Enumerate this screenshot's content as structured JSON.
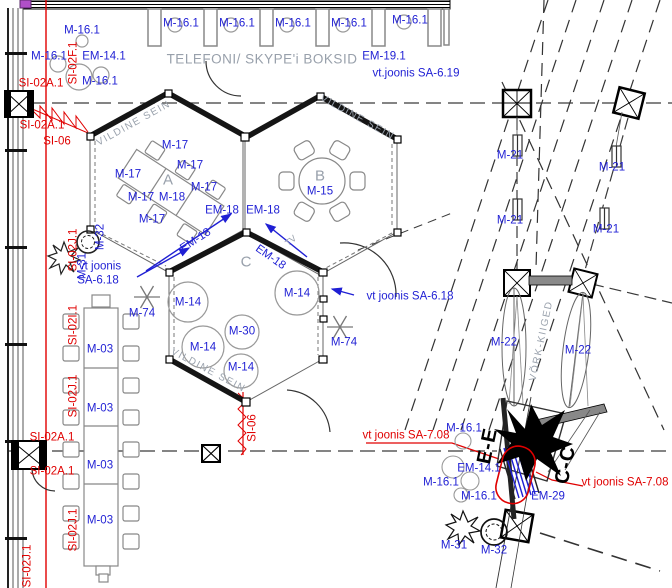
{
  "colors": {
    "label_blue": "#1f1fd4",
    "ref_red": "#e00000",
    "annotation_gray": "#98a0ab",
    "line_black": "#1a1a1a"
  },
  "rooms": {
    "a": "A",
    "b": "B",
    "c": "C"
  },
  "area_titles": {
    "phone_booths": "TELEFONI/ SKYPE'i BOKSID",
    "felt_wall": "VILDINE SEIN",
    "net_swings": "VÕRK-KIIGED"
  },
  "labels": [
    {
      "text": "M-16.1"
    },
    {
      "text": "M-16.1"
    },
    {
      "text": "EM-14.1"
    },
    {
      "text": "M-16.1"
    },
    {
      "text": "SI-02F.1"
    },
    {
      "text": "SI-02A.1"
    },
    {
      "text": "SI-02A.1"
    },
    {
      "text": "SI-06"
    },
    {
      "text": "M-16.1"
    },
    {
      "text": "M-16.1"
    },
    {
      "text": "M-16.1"
    },
    {
      "text": "M-16.1"
    },
    {
      "text": "M-16.1"
    },
    {
      "text": "TELEFONI/ SKYPE'i BOKSID"
    },
    {
      "text": "EM-19.1"
    },
    {
      "text": "vt.joonis SA-6.19"
    },
    {
      "text": "VILDINE SEIN"
    },
    {
      "text": "VILDINE SEIN"
    },
    {
      "text": "VILDINE SEIN"
    },
    {
      "text": "A"
    },
    {
      "text": "B"
    },
    {
      "text": "C"
    },
    {
      "text": "M-17"
    },
    {
      "text": "M-17"
    },
    {
      "text": "M-17"
    },
    {
      "text": "M-17"
    },
    {
      "text": "M-17"
    },
    {
      "text": "M-18"
    },
    {
      "text": "M-17"
    },
    {
      "text": "M-15"
    },
    {
      "text": "EM-18"
    },
    {
      "text": "EM-18"
    },
    {
      "text": "EM-18"
    },
    {
      "text": "EM-18"
    },
    {
      "text": "TV"
    },
    {
      "text": "vt joonis"
    },
    {
      "text": "SA-6.18"
    },
    {
      "text": "M-74"
    },
    {
      "text": "M-74"
    },
    {
      "text": "M-14"
    },
    {
      "text": "M-14"
    },
    {
      "text": "M-14"
    },
    {
      "text": "M-30"
    },
    {
      "text": "M-14"
    },
    {
      "text": "vt joonis SA-6.18"
    },
    {
      "text": "M-03"
    },
    {
      "text": "M-03"
    },
    {
      "text": "M-03"
    },
    {
      "text": "M-03"
    },
    {
      "text": "SI-02J.1"
    },
    {
      "text": "M-32"
    },
    {
      "text": "M-31"
    },
    {
      "text": "SI-02I.1"
    },
    {
      "text": "SI-02J.1"
    },
    {
      "text": "SI-02A.1"
    },
    {
      "text": "SI-02A.1"
    },
    {
      "text": "SI-02J.1"
    },
    {
      "text": "SI-02J.1"
    },
    {
      "text": "M-21"
    },
    {
      "text": "M-21"
    },
    {
      "text": "M-21"
    },
    {
      "text": "M-21"
    },
    {
      "text": "M-22"
    },
    {
      "text": "M-22"
    },
    {
      "text": "VÕRK-KIIGED"
    },
    {
      "text": "SI-06"
    },
    {
      "text": "M-16.1"
    },
    {
      "text": "EM-14.1"
    },
    {
      "text": "M-16.1"
    },
    {
      "text": "M-16.1"
    },
    {
      "text": "EM-29"
    },
    {
      "text": "vt joonis SA-7.08"
    },
    {
      "text": "vt joonis SA-7.08"
    },
    {
      "text": "E-E"
    },
    {
      "text": "C-C"
    },
    {
      "text": "M-31"
    },
    {
      "text": "M-32"
    }
  ]
}
